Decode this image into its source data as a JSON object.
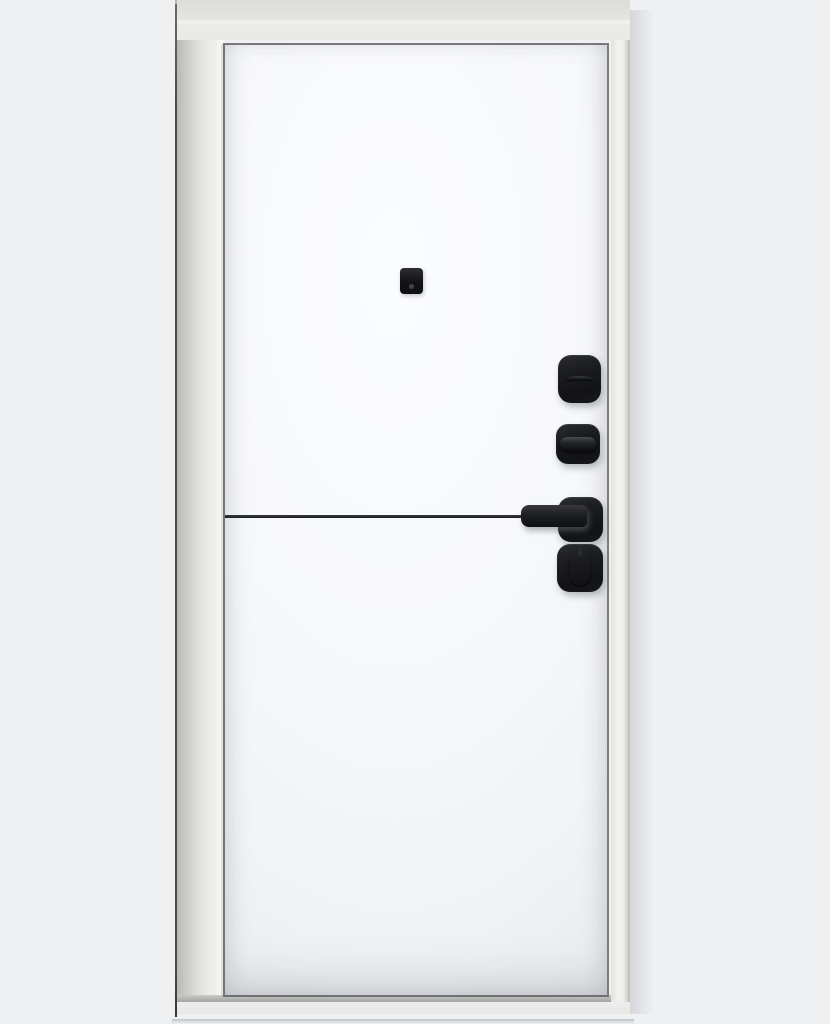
{
  "image": {
    "kind": "product-photo",
    "subject": "White interior entry door with matte black hardware, closed, front view"
  },
  "colors": {
    "background": "#eff0f2",
    "frame_face": "#e9eae6",
    "frame_top": "#e0e1dd",
    "frame_side_shadow": "#bcbdbb",
    "frame_edge_dark": "#4b4b49",
    "door_white": "#f8f9fb",
    "panel_gap": "#55565a",
    "hardware_black": "#151619",
    "trim_line": "#1f2022"
  },
  "components": {
    "frame": {
      "label": "Door frame and casing"
    },
    "leaf": {
      "label": "White door leaf"
    },
    "peephole": {
      "label": "Peephole viewer"
    },
    "cylinder": {
      "label": "Keyhole escutcheon with cover slot"
    },
    "upper_thumbturn": {
      "label": "Night-latch escutcheon with horizontal thumbturn"
    },
    "handle": {
      "label": "Black lever handle on square rosette"
    },
    "lower_thumbturn": {
      "label": "Deadbolt escutcheon with vertical thumbturn"
    },
    "trim": {
      "label": "Black horizontal decorative trim strip"
    }
  }
}
